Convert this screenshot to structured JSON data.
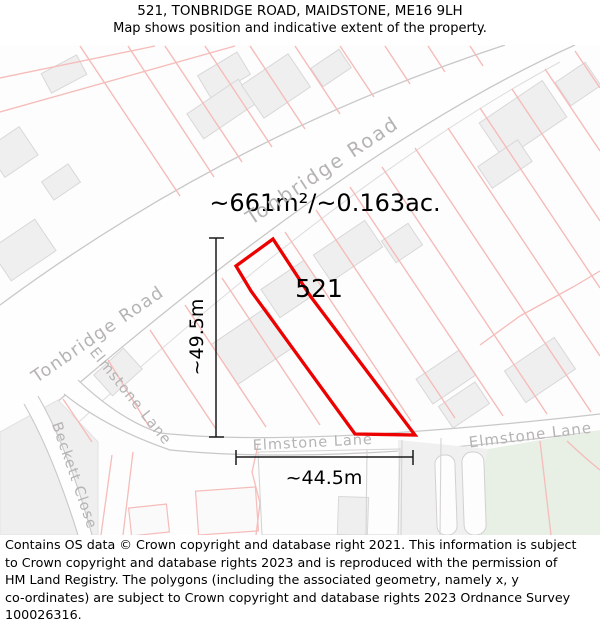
{
  "title": {
    "line1": "521, TONBRIDGE ROAD, MAIDSTONE, ME16 9LH",
    "line2": "Map shows position and indicative extent of the property."
  },
  "map": {
    "area_label": "~661m²/~0.163ac.",
    "parcel_number": "521",
    "dimensions": {
      "vertical": "~49.5m",
      "horizontal": "~44.5m"
    },
    "roads": {
      "tonbridge_top": "Tonbridge Road",
      "tonbridge_left": "Tonbridge Road",
      "elmstone_branch": "Elmstone Lane",
      "elmstone_center": "Elmstone Lane",
      "elmstone_right": "Elmstone Lane",
      "beckett": "Beckett Close"
    }
  },
  "footer": {
    "lines": [
      "Contains OS data © Crown copyright and database right 2021. This information is subject",
      "to Crown copyright and database rights 2023 and is reproduced with the permission of",
      "HM Land Registry. The polygons (including the associated geometry, namely x, y",
      "co-ordinates) are subject to Crown copyright and database rights 2023 Ordnance Survey",
      "100026316."
    ]
  },
  "colors": {
    "plot_outline": "#ec0000",
    "parcel_line": "#f5bcb9",
    "road_edge": "#c9c7c7",
    "road_fill": "#fefefe",
    "road_label": "#b5b3b3",
    "building_fill": "#f0efef",
    "building_stroke": "#d9d7d7",
    "green_area": "#e8efe5",
    "dimension": "#1a1a1a",
    "map_bg": "#fdfdfd",
    "gray_zone": "#f0efef"
  }
}
